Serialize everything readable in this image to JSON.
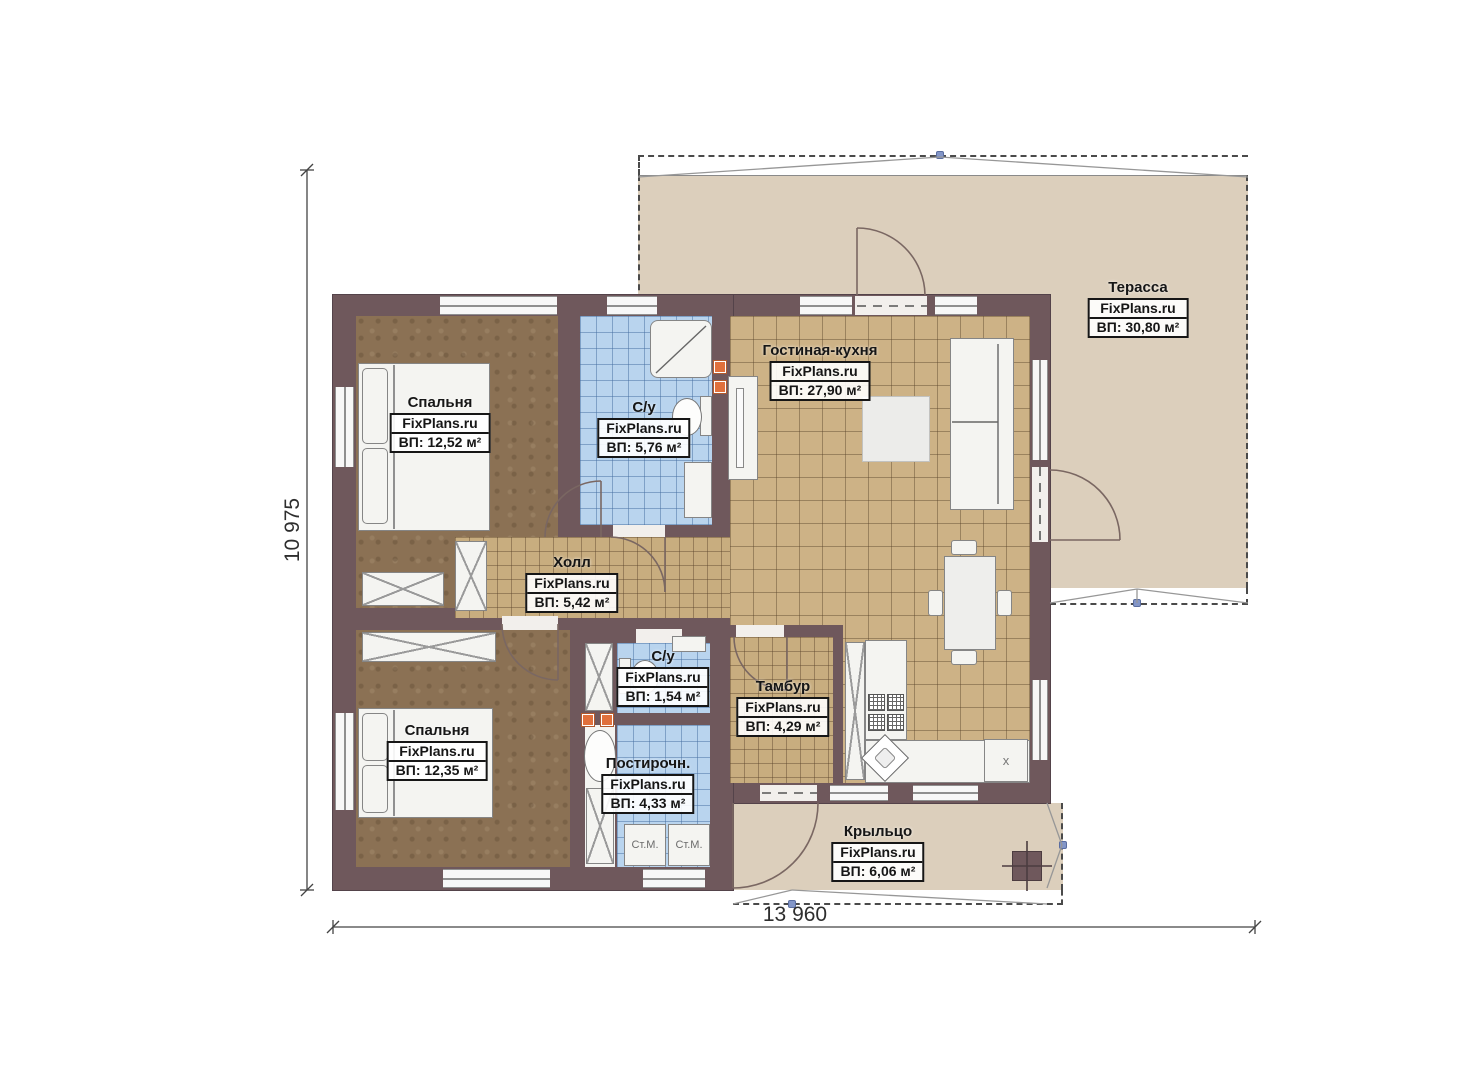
{
  "plan": {
    "brand": "FixPlans.ru",
    "rooms": [
      {
        "id": "bedroom-1",
        "name": "Спальня",
        "brand": "FixPlans.ru",
        "area": "ВП: 12,52 м²"
      },
      {
        "id": "bathroom-1",
        "name": "С/у",
        "brand": "FixPlans.ru",
        "area": "ВП: 5,76 м²"
      },
      {
        "id": "living-kitchen",
        "name": "Гостиная-кухня",
        "brand": "FixPlans.ru",
        "area": "ВП: 27,90 м²"
      },
      {
        "id": "terrace",
        "name": "Терасса",
        "brand": "FixPlans.ru",
        "area": "ВП: 30,80 м²"
      },
      {
        "id": "hall",
        "name": "Холл",
        "brand": "FixPlans.ru",
        "area": "ВП: 5,42 м²"
      },
      {
        "id": "bathroom-2",
        "name": "С/у",
        "brand": "FixPlans.ru",
        "area": "ВП: 1,54 м²"
      },
      {
        "id": "vestibule",
        "name": "Тамбур",
        "brand": "FixPlans.ru",
        "area": "ВП: 4,29 м²"
      },
      {
        "id": "bedroom-2",
        "name": "Спальня",
        "brand": "FixPlans.ru",
        "area": "ВП: 12,35 м²"
      },
      {
        "id": "laundry",
        "name": "Постирочн.",
        "brand": "FixPlans.ru",
        "area": "ВП: 4,33 м²"
      },
      {
        "id": "porch",
        "name": "Крыльцо",
        "brand": "FixPlans.ru",
        "area": "ВП: 6,06 м²"
      }
    ],
    "dimensions": {
      "height_label": "10 975",
      "width_label": "13 960"
    },
    "appliances": {
      "washer_1": "Ст.М.",
      "washer_2": "Ст.М.",
      "fridge_mark": "x"
    },
    "colors": {
      "wall": "#6f585c",
      "tile_tan": "#cdb286",
      "tile_blue": "#b9d4ee",
      "floor_brown": "#8b7154",
      "outdoor": "#dccfbc",
      "accent_orange": "#e0703c"
    }
  }
}
